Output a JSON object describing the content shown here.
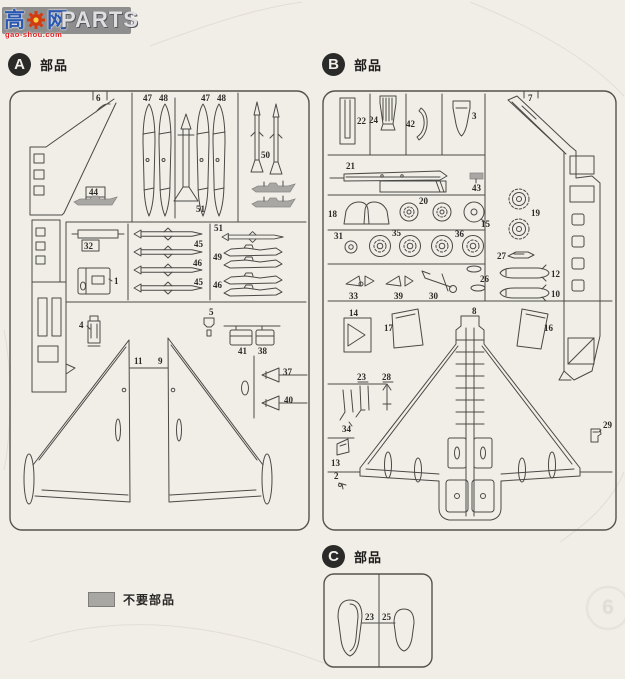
{
  "watermark": {
    "cn_first": "高",
    "cn_second": "网",
    "site": "gao-shou.com",
    "brand": "PARTS"
  },
  "legend": {
    "unused_label": "不要部品"
  },
  "page_marker": "6",
  "panels": {
    "a": {
      "badge": "A",
      "title": "部品",
      "parts": {
        "p6": "6",
        "p47_1": "47",
        "p48_1": "48",
        "p47_2": "47",
        "p48_2": "48",
        "p51_center": "51",
        "p50": "50",
        "p44": "44",
        "p32": "32",
        "p1": "1",
        "p45_1": "45",
        "p46_mid": "46",
        "p45_2": "45",
        "p51_right": "51",
        "p49": "49",
        "p46_right": "46",
        "p4": "4",
        "p5": "5",
        "p41": "41",
        "p38": "38",
        "p11": "11",
        "p9": "9",
        "p37": "37",
        "p40": "40"
      }
    },
    "b": {
      "badge": "B",
      "title": "部品",
      "parts": {
        "p22": "22",
        "p24": "24",
        "p42": "42",
        "p3": "3",
        "p7": "7",
        "p21": "21",
        "p43": "43",
        "p18": "18",
        "p20": "20",
        "p15": "15",
        "p19": "19",
        "p31": "31",
        "p35": "35",
        "p36": "36",
        "p27": "27",
        "p12": "12",
        "p10": "10",
        "p26": "26",
        "p33": "33",
        "p39": "39",
        "p30": "30",
        "p14": "14",
        "p17": "17",
        "p8": "8",
        "p16": "16",
        "p23": "23",
        "p28": "28",
        "p34": "34",
        "p13": "13",
        "p2": "2",
        "p29": "29"
      }
    },
    "c": {
      "badge": "C",
      "title": "部品",
      "parts": {
        "p23": "23",
        "p25": "25"
      }
    }
  }
}
